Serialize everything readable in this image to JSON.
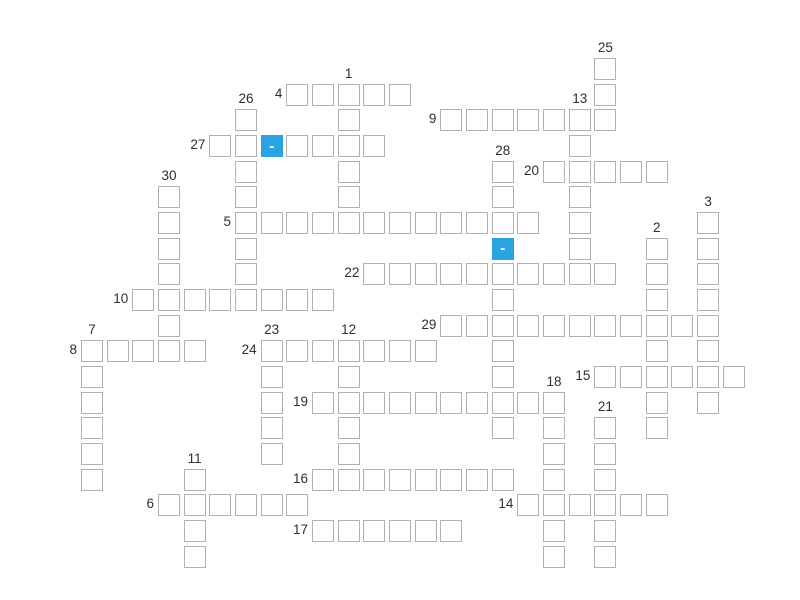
{
  "puzzle": {
    "type": "crossword",
    "blank_symbol": "-",
    "colors": {
      "background": "#ffffff",
      "cell_bg": "#ffffff",
      "cell_border": "#b1b1b1",
      "highlight": "#29a3e2",
      "highlight_text": "#ffffff",
      "number_text": "#2f2f2f"
    },
    "grid": {
      "origin_x": 81,
      "origin_y": 58,
      "cell_size": 22,
      "spacing": 25.67,
      "rows": 20,
      "cols": 26
    },
    "words": [
      {
        "num": 1,
        "dir": "down",
        "row": 1,
        "col": 10,
        "len": 6
      },
      {
        "num": 2,
        "dir": "down",
        "row": 7,
        "col": 22,
        "len": 8
      },
      {
        "num": 3,
        "dir": "down",
        "row": 6,
        "col": 24,
        "len": 8
      },
      {
        "num": 4,
        "dir": "across",
        "row": 1,
        "col": 8,
        "len": 5
      },
      {
        "num": 5,
        "dir": "across",
        "row": 6,
        "col": 6,
        "len": 12
      },
      {
        "num": 6,
        "dir": "across",
        "row": 17,
        "col": 3,
        "len": 6
      },
      {
        "num": 7,
        "dir": "down",
        "row": 11,
        "col": 0,
        "len": 6
      },
      {
        "num": 8,
        "dir": "across",
        "row": 11,
        "col": 0,
        "len": 5
      },
      {
        "num": 9,
        "dir": "across",
        "row": 2,
        "col": 14,
        "len": 7
      },
      {
        "num": 10,
        "dir": "across",
        "row": 9,
        "col": 2,
        "len": 8
      },
      {
        "num": 11,
        "dir": "down",
        "row": 16,
        "col": 4,
        "len": 4
      },
      {
        "num": 12,
        "dir": "down",
        "row": 11,
        "col": 10,
        "len": 6
      },
      {
        "num": 13,
        "dir": "down",
        "row": 2,
        "col": 19,
        "len": 7
      },
      {
        "num": 14,
        "dir": "across",
        "row": 17,
        "col": 17,
        "len": 6
      },
      {
        "num": 15,
        "dir": "across",
        "row": 12,
        "col": 20,
        "len": 6
      },
      {
        "num": 16,
        "dir": "across",
        "row": 16,
        "col": 9,
        "len": 8
      },
      {
        "num": 17,
        "dir": "across",
        "row": 18,
        "col": 9,
        "len": 6
      },
      {
        "num": 18,
        "dir": "down",
        "row": 13,
        "col": 18,
        "len": 7
      },
      {
        "num": 19,
        "dir": "across",
        "row": 13,
        "col": 9,
        "len": 10
      },
      {
        "num": 20,
        "dir": "across",
        "row": 4,
        "col": 18,
        "len": 5
      },
      {
        "num": 21,
        "dir": "down",
        "row": 14,
        "col": 20,
        "len": 6
      },
      {
        "num": 22,
        "dir": "across",
        "row": 8,
        "col": 11,
        "len": 10
      },
      {
        "num": 23,
        "dir": "down",
        "row": 11,
        "col": 7,
        "len": 5
      },
      {
        "num": 24,
        "dir": "across",
        "row": 11,
        "col": 7,
        "len": 7
      },
      {
        "num": 25,
        "dir": "down",
        "row": 0,
        "col": 20,
        "len": 3
      },
      {
        "num": 26,
        "dir": "down",
        "row": 2,
        "col": 6,
        "len": 7
      },
      {
        "num": 27,
        "dir": "across",
        "row": 3,
        "col": 5,
        "len": 7
      },
      {
        "num": 28,
        "dir": "down",
        "row": 4,
        "col": 16,
        "len": 11
      },
      {
        "num": 29,
        "dir": "across",
        "row": 10,
        "col": 14,
        "len": 10
      },
      {
        "num": 30,
        "dir": "down",
        "row": 5,
        "col": 3,
        "len": 7
      }
    ],
    "highlighted_cells": [
      {
        "row": 3,
        "col": 7,
        "symbol": "-"
      },
      {
        "row": 7,
        "col": 16,
        "symbol": "-"
      }
    ]
  }
}
